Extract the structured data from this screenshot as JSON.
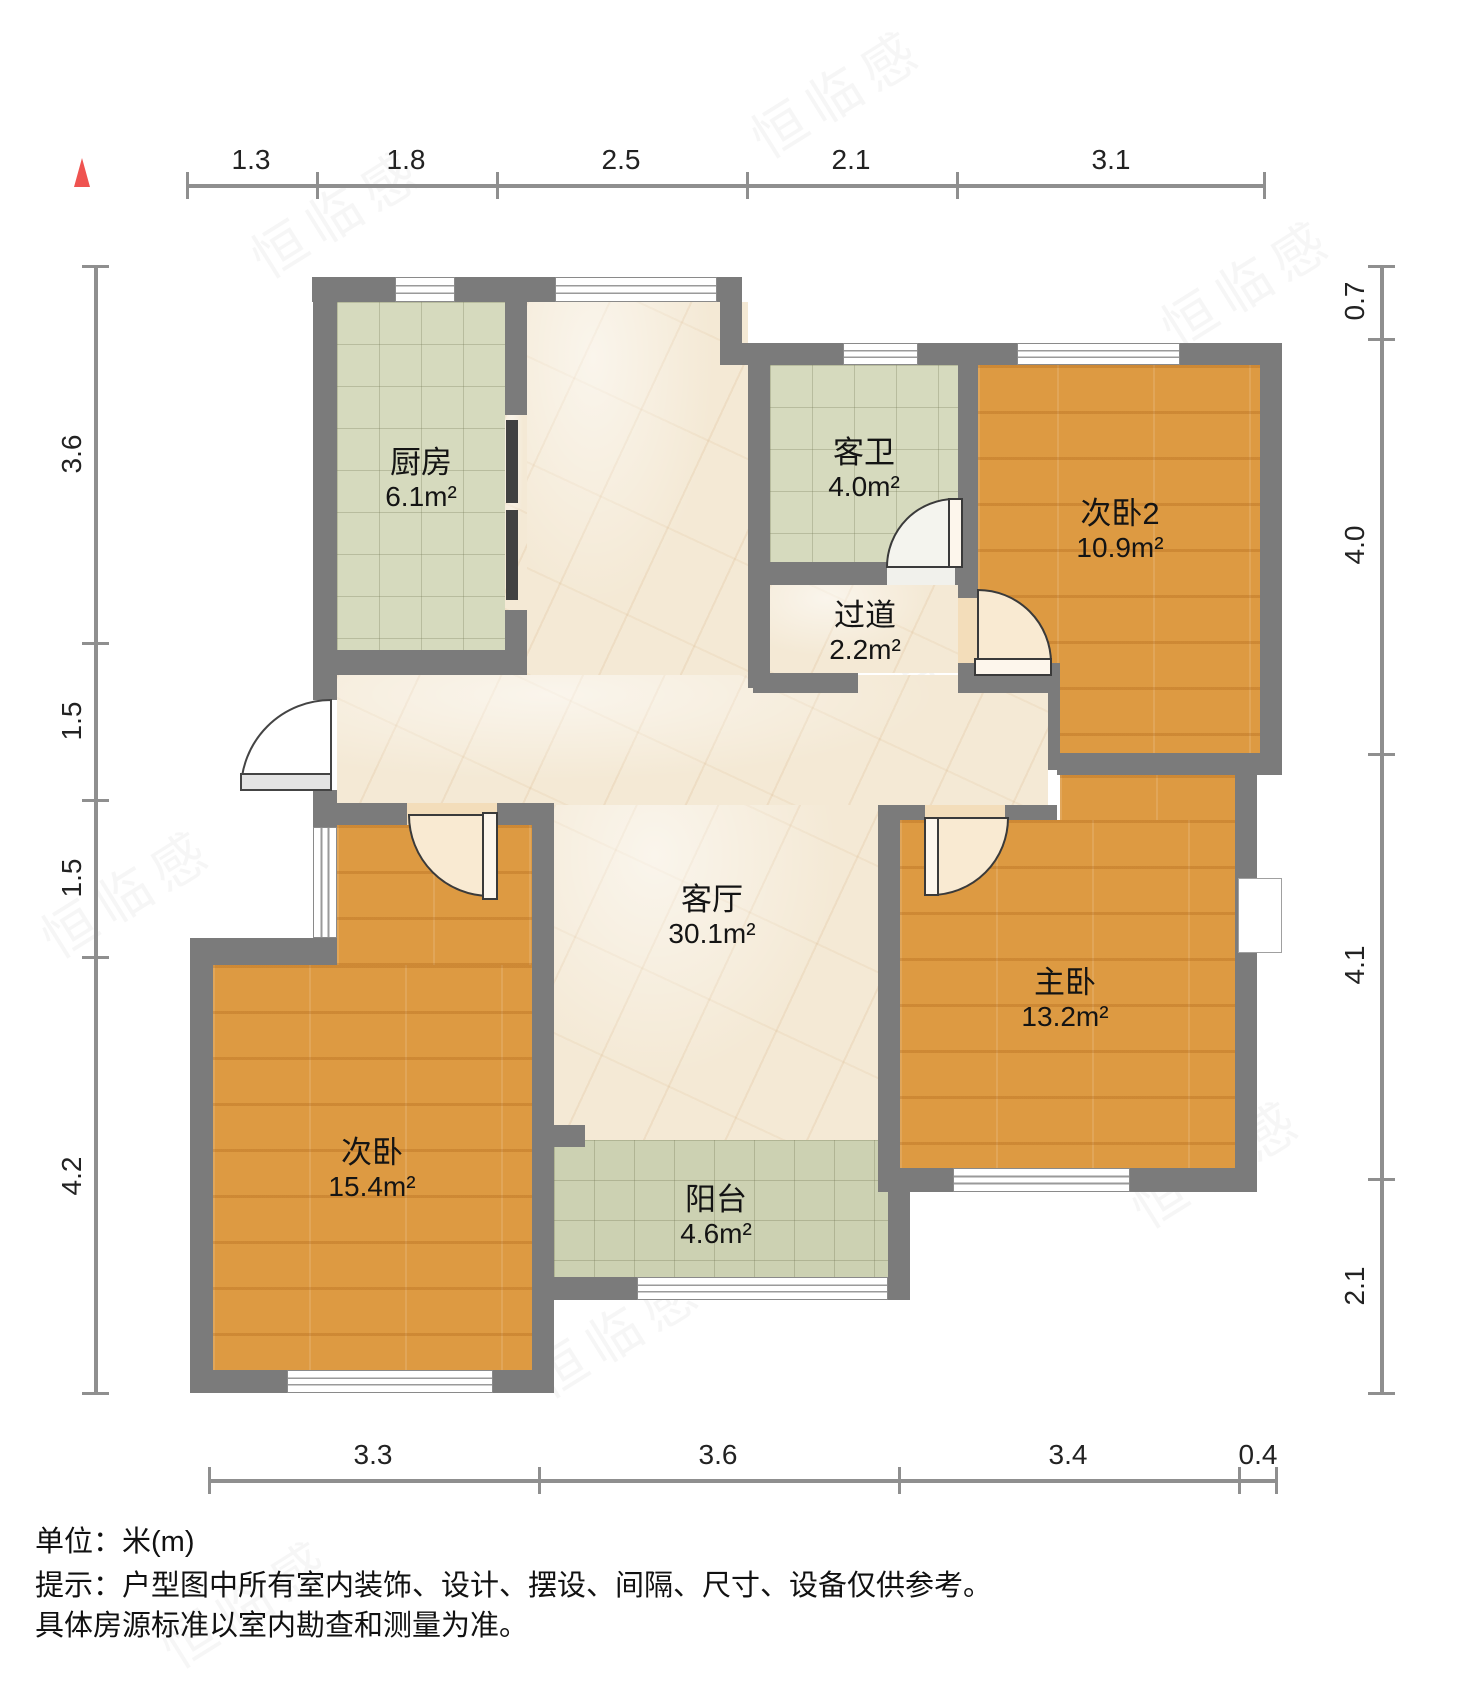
{
  "rulers": {
    "top": {
      "labels": [
        "1.3",
        "1.8",
        "2.5",
        "2.1",
        "3.1"
      ]
    },
    "bottom": {
      "labels": [
        "3.3",
        "3.6",
        "3.4",
        "0.4"
      ]
    },
    "left": {
      "labels": [
        "3.6",
        "1.5",
        "1.5",
        "4.2"
      ]
    },
    "right": {
      "labels": [
        "0.7",
        "4.0",
        "4.1",
        "2.1"
      ]
    }
  },
  "rooms": {
    "kitchen": {
      "name": "厨房",
      "area": "6.1m²"
    },
    "guest_bathroom": {
      "name": "客卫",
      "area": "4.0m²"
    },
    "hallway": {
      "name": "过道",
      "area": "2.2m²"
    },
    "bedroom2": {
      "name": "次卧2",
      "area": "10.9m²"
    },
    "living_room": {
      "name": "客厅",
      "area": "30.1m²"
    },
    "master_bedroom": {
      "name": "主卧",
      "area": "13.2m²"
    },
    "bedroom1": {
      "name": "次卧",
      "area": "15.4m²"
    },
    "balcony": {
      "name": "阳台",
      "area": "4.6m²"
    }
  },
  "footer": {
    "unit_line": "单位：米(m)",
    "notice_line1": "提示：户型图中所有室内装饰、设计、摆设、间隔、尺寸、设备仅供参考。",
    "notice_line2": "具体房源标准以室内勘查和测量为准。"
  },
  "watermark": {
    "text": "恒临感"
  },
  "colors": {
    "wall": "#7b7b7b",
    "wood_floor": "#dd9a42",
    "tile_floor": "#d6dabe",
    "marble_floor": "#f4e9d5",
    "north_arrow": "#ef5350",
    "ruler": "#8f8f8f"
  }
}
